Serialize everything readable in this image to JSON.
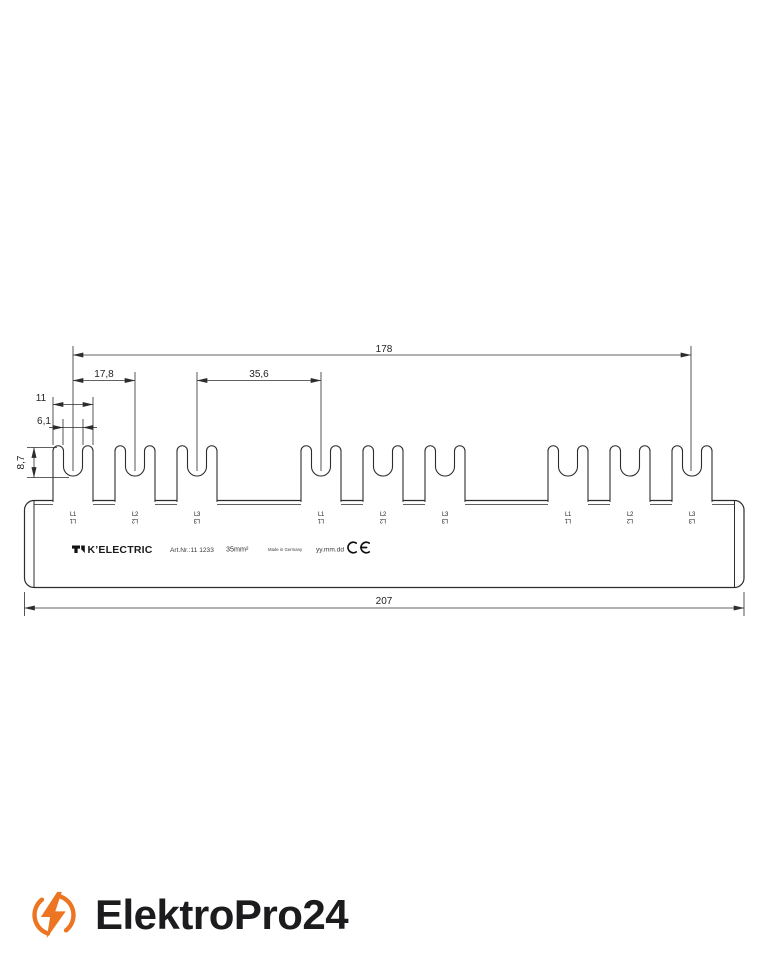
{
  "drawing": {
    "dims": {
      "total_pitch": "178",
      "pitch": "17,8",
      "double_pitch": "35,6",
      "fork_width": "11",
      "slot_width": "6,1",
      "slot_depth": "8,7",
      "overall_length": "207"
    },
    "poles": [
      "L1",
      "L2",
      "L3",
      "L1",
      "L2",
      "L3",
      "L1",
      "L2",
      "L3"
    ],
    "branding": {
      "manufacturer": "K’ELECTRIC",
      "art_nr": "Art.Nr.:11 1233",
      "cross_section": "35mm²",
      "made_in": "Made in Germany",
      "date_placeholder": "yy.mm.dd",
      "ce_mark": "CE"
    }
  },
  "footer": {
    "brand": "ElektroPro24"
  },
  "colors": {
    "accent": "#ed7522",
    "line": "#2d2d2d",
    "text": "#1c1c1e"
  }
}
